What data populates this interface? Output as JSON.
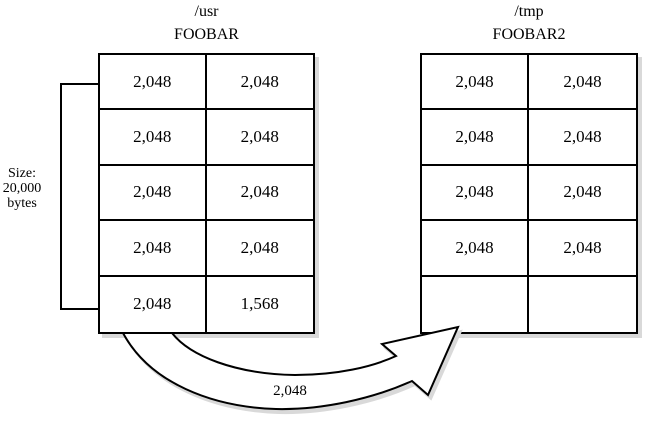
{
  "diagram": {
    "source_volume": {
      "path_label": "/usr",
      "file_name": "FOOBAR",
      "rows": [
        [
          "2,048",
          "2,048"
        ],
        [
          "2,048",
          "2,048"
        ],
        [
          "2,048",
          "2,048"
        ],
        [
          "2,048",
          "2,048"
        ],
        [
          "2,048",
          "1,568"
        ]
      ]
    },
    "dest_volume": {
      "path_label": "/tmp",
      "file_name": "FOOBAR2",
      "rows": [
        [
          "2,048",
          "2,048"
        ],
        [
          "2,048",
          "2,048"
        ],
        [
          "2,048",
          "2,048"
        ],
        [
          "2,048",
          "2,048"
        ],
        [
          "",
          ""
        ]
      ]
    },
    "size_annotation": {
      "line1": "Size:",
      "line2": "20,000",
      "line3": "bytes"
    },
    "transfer_arrow": {
      "label": "2,048"
    },
    "colors": {
      "line": "#000000",
      "fill": "#ffffff",
      "shadow": "#d9d9d9"
    }
  }
}
